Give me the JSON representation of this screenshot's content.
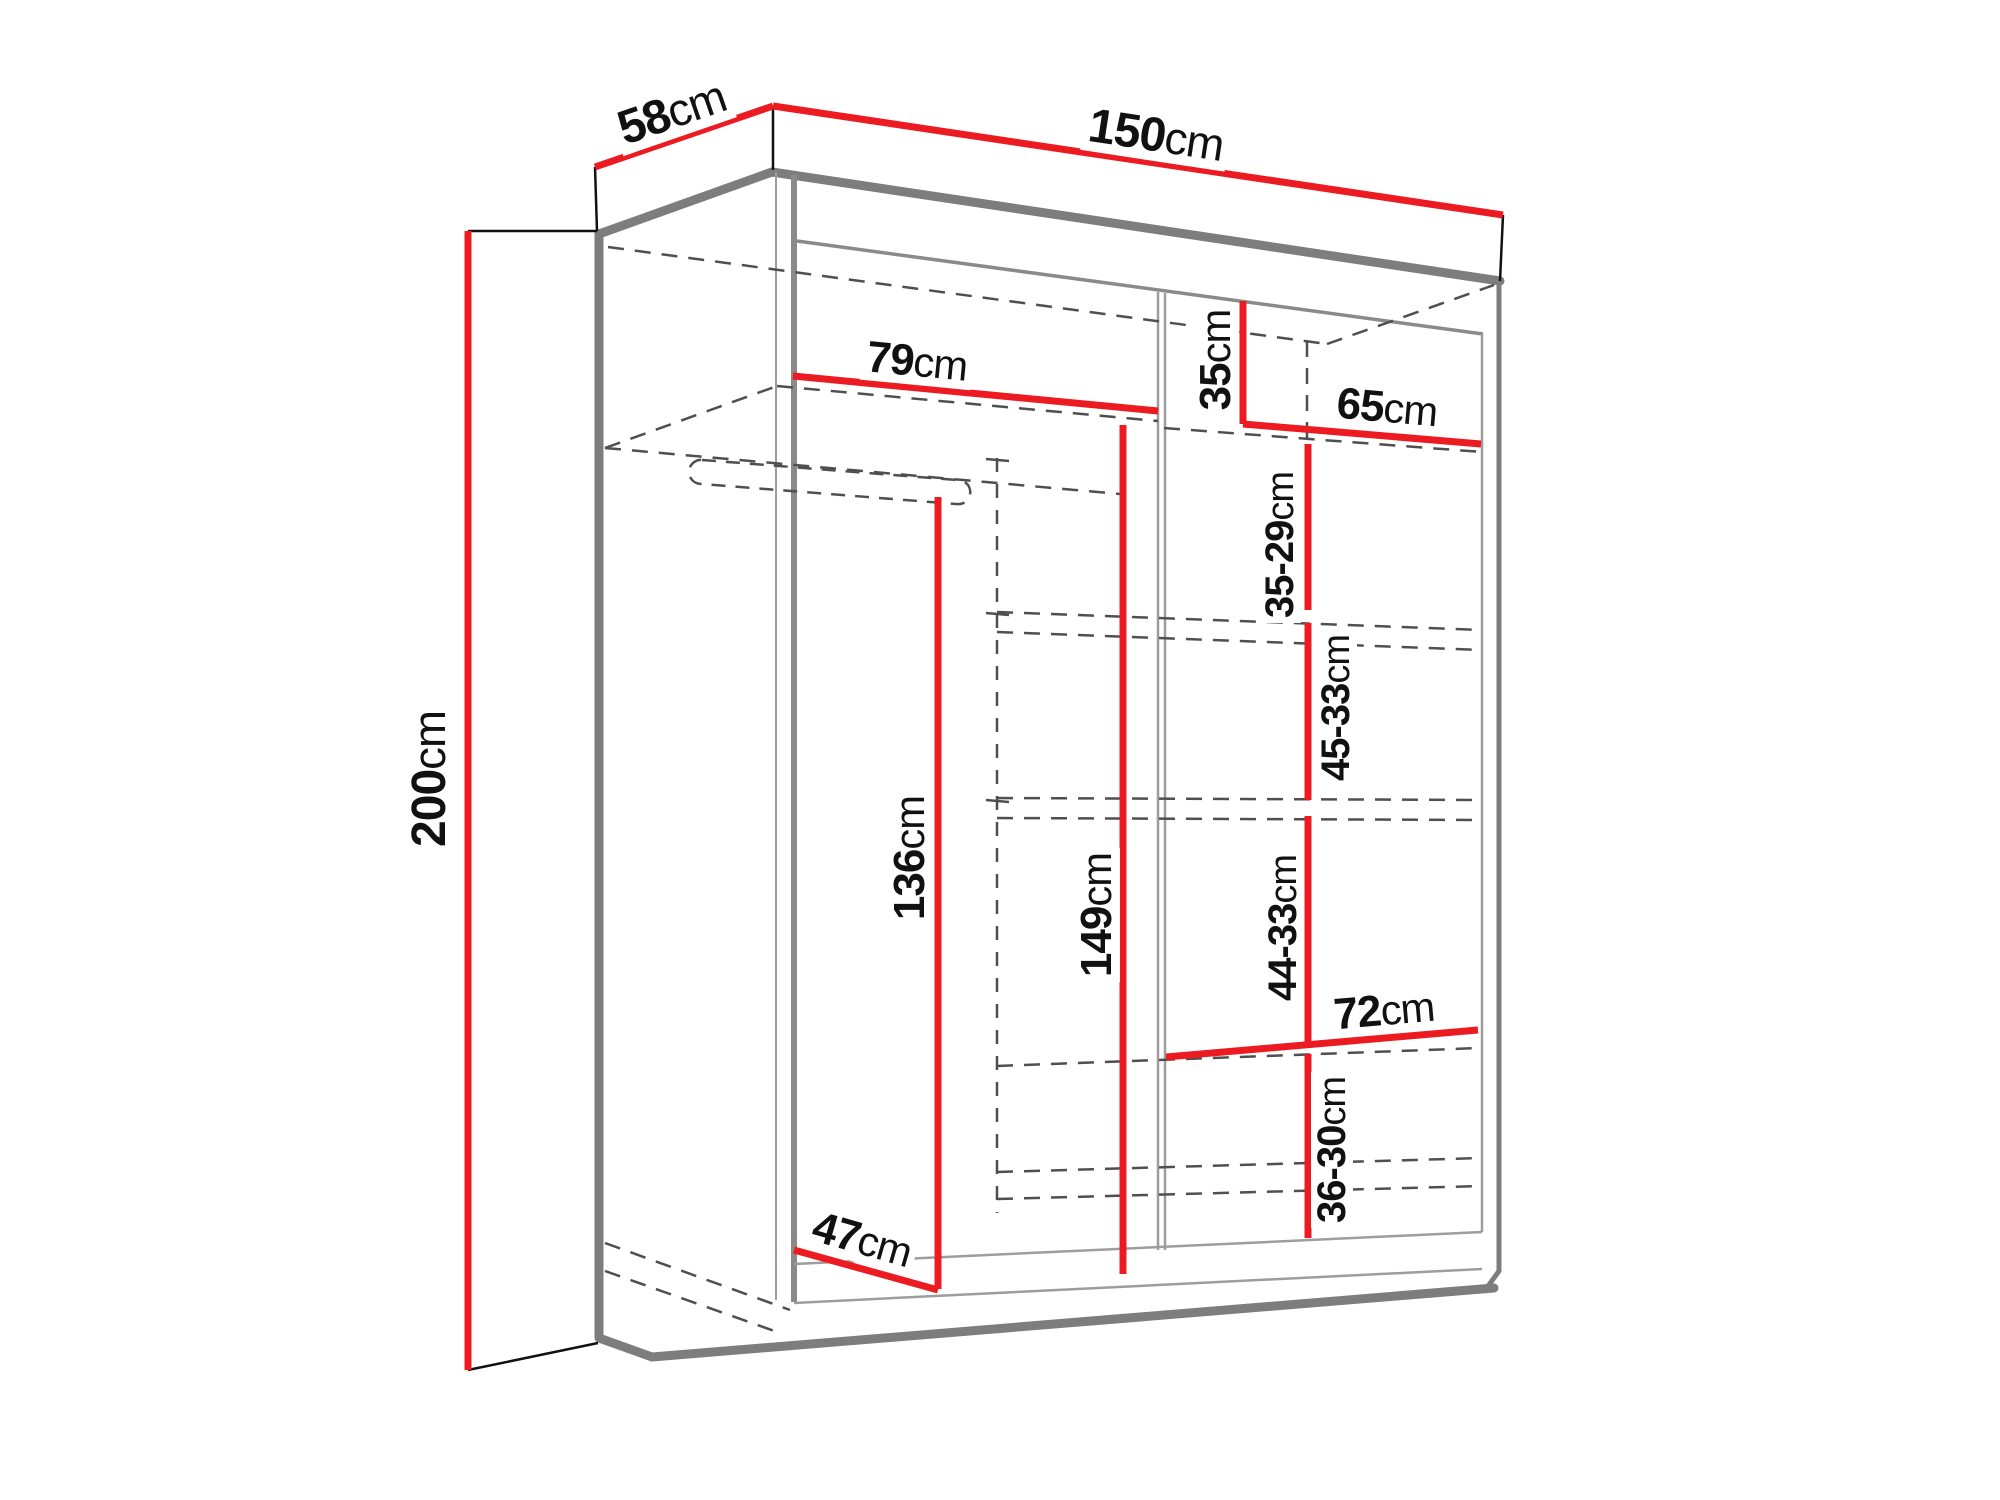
{
  "diagram": {
    "type": "wardrobe-dimension-drawing",
    "description": "Technical line drawing of a two-door sliding wardrobe with red dimension lines",
    "colors": {
      "dimension_red": "#ec1b22",
      "outline_gray": "#7d7d7d",
      "hidden_line_gray": "#4f4f4f",
      "tick_black": "#111111",
      "background": "#ffffff"
    },
    "overall_dimensions": {
      "width": "150cm",
      "depth": "58cm",
      "height": "200cm"
    },
    "interior_dimensions": {
      "left_shelf_width": "79cm",
      "top_right_compartment_height": "35cm",
      "top_right_shelf_width": "65cm",
      "right_gap_1": "35-29cm",
      "right_gap_2": "45-33cm",
      "right_gap_3": "44-33cm",
      "right_gap_4": "36-30cm",
      "right_lower_shelf_width": "72cm",
      "middle_interior_height": "149cm",
      "hanging_space_height": "136cm",
      "interior_depth_diagonal": "47cm"
    }
  },
  "labels": {
    "width": {
      "value": "150",
      "unit": "cm"
    },
    "depth": {
      "value": "58",
      "unit": "cm"
    },
    "height": {
      "value": "200",
      "unit": "cm"
    },
    "shelf79": {
      "value": "79",
      "unit": "cm"
    },
    "vert35": {
      "value": "35",
      "unit": "cm"
    },
    "shelf65": {
      "value": "65",
      "unit": "cm"
    },
    "gap3529": {
      "value": "35-29",
      "unit": "cm"
    },
    "gap4533": {
      "value": "45-33",
      "unit": "cm"
    },
    "gap4433": {
      "value": "44-33",
      "unit": "cm"
    },
    "gap3630": {
      "value": "36-30",
      "unit": "cm"
    },
    "shelf72": {
      "value": "72",
      "unit": "cm"
    },
    "height149": {
      "value": "149",
      "unit": "cm"
    },
    "height136": {
      "value": "136",
      "unit": "cm"
    },
    "diag47": {
      "value": "47",
      "unit": "cm"
    }
  }
}
